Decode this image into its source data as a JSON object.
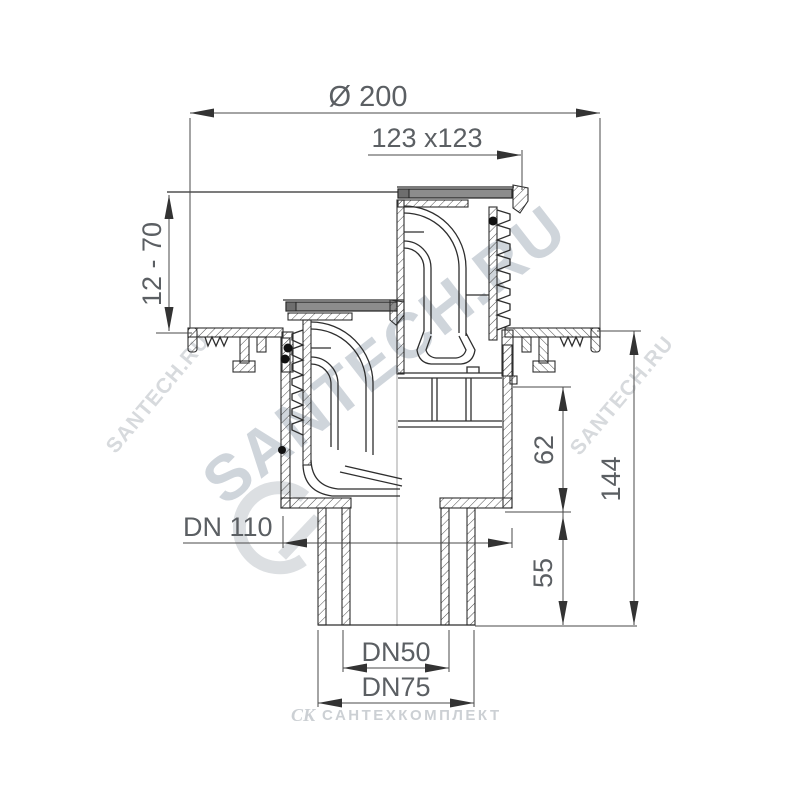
{
  "drawing": {
    "type": "technical-section-drawing",
    "subject": "adjustable floor drain with vertical outlet, shown in raised and lowered grate positions",
    "dimensions": {
      "flange_diameter": "Ø 200",
      "grate_size": "123 x123",
      "adjust_height": "12 - 70",
      "body_diameter": "DN 110",
      "upper_height": "62",
      "spigot_height": "55",
      "total_height": "144",
      "outlet_inner": "DN50",
      "outlet_outer": "DN75"
    },
    "watermarks": {
      "center": "SANTECH.RU",
      "left": "SANTECH.RU",
      "right": "SANTECH.RU"
    },
    "footer": {
      "logo_glyph": "СК",
      "brand": "САНТЕХКОМПЛЕКТ"
    },
    "colors": {
      "line": "#2e2e2e",
      "dimension": "#4a4a4a",
      "dim_text": "#5b5f63",
      "grate_fill": "#8c8c8c",
      "watermark": "#c0c7d0",
      "background": "#ffffff"
    }
  }
}
